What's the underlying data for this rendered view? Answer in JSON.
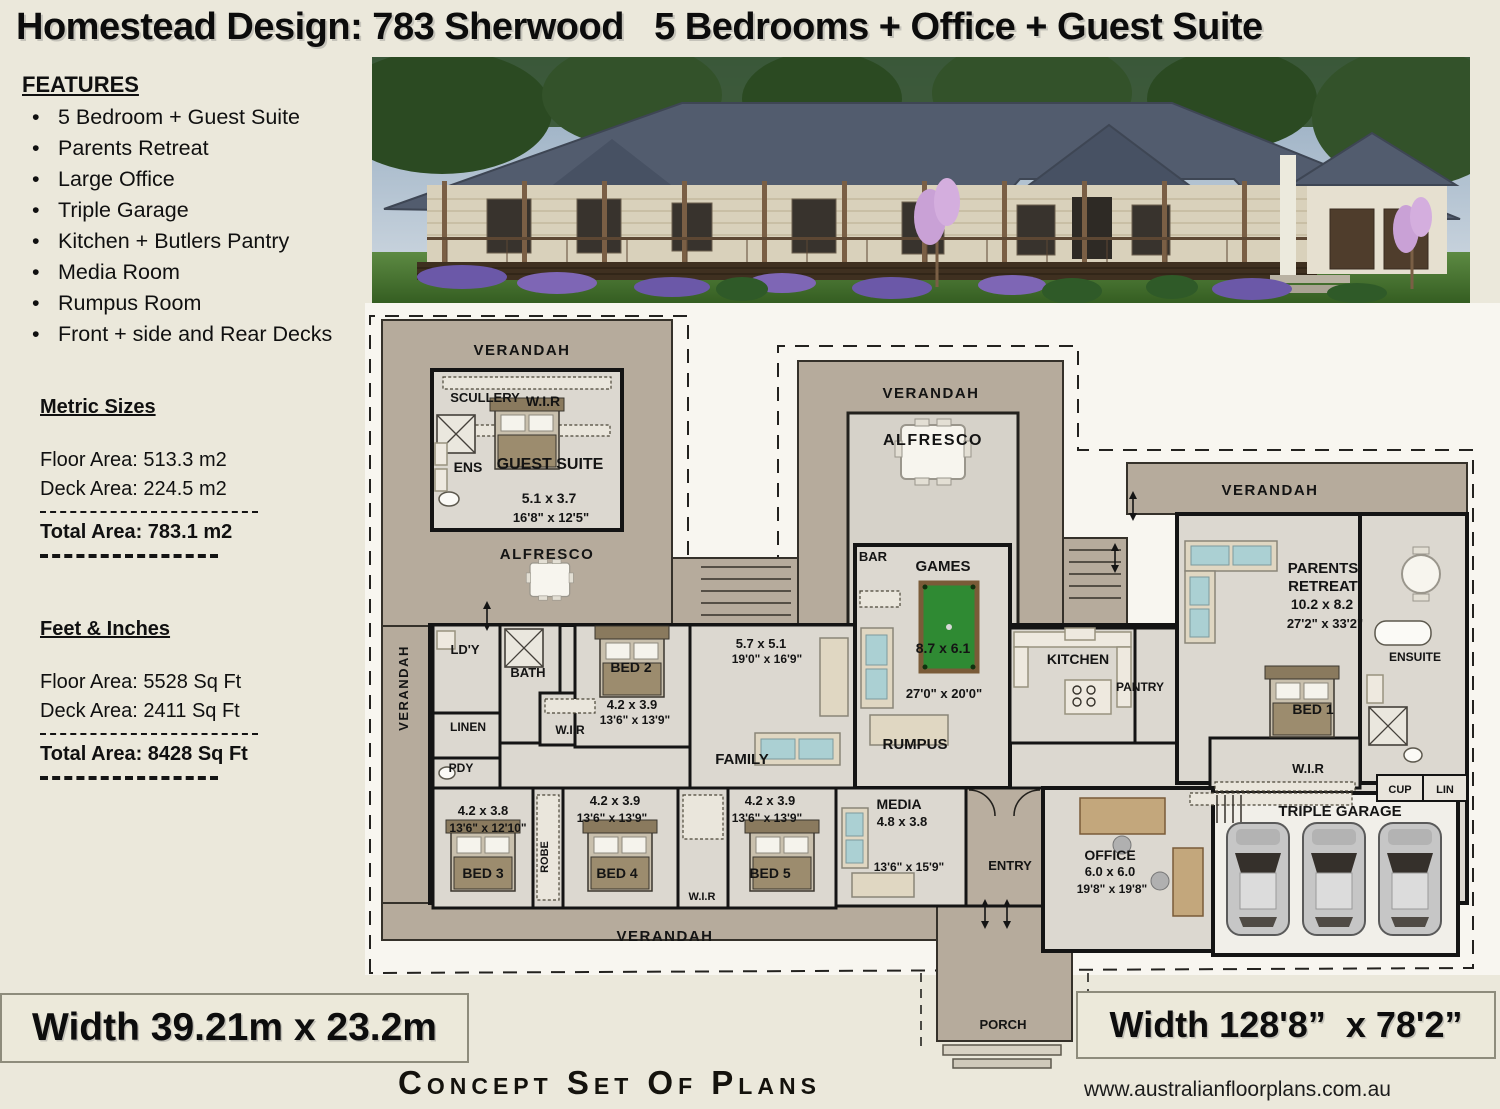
{
  "title": "Homestead Design: 783 Sherwood   5 Bedrooms + Office + Guest Suite",
  "features": {
    "heading": "FEATURES",
    "items": [
      "5 Bedroom + Guest Suite",
      "Parents Retreat",
      "Large Office",
      "Triple Garage",
      "Kitchen + Butlers Pantry",
      "Media Room",
      "Rumpus Room",
      "Front + side and Rear Decks"
    ]
  },
  "metric": {
    "heading": "Metric Sizes",
    "floor": "Floor Area: 513.3 m2",
    "deck": "Deck Area: 224.5 m2",
    "total": "Total Area: 783.1 m2"
  },
  "imperial": {
    "heading": "Feet & Inches",
    "floor": "Floor Area: 5528 Sq Ft",
    "deck": "Deck Area: 2411 Sq Ft",
    "total": "Total Area: 8428 Sq Ft"
  },
  "plan": {
    "verandah": "VERANDAH",
    "alfresco": "ALFRESCO",
    "porch": "PORCH",
    "bar": "BAR",
    "scullery": "SCULLERY",
    "wir": "W.I.R",
    "ens": "ENS",
    "ensuite": "ENSUITE",
    "cup": "CUP",
    "lin": "LIN",
    "ldy": "LD'Y",
    "bath": "BATH",
    "linen": "LINEN",
    "pdy": "PDY",
    "robe": "ROBE",
    "kitchen": "KITCHEN",
    "pantry": "PANTRY",
    "rumpus": "RUMPUS",
    "family": "FAMILY",
    "entry": "ENTRY",
    "media": "MEDIA",
    "office": "OFFICE",
    "garage": "TRIPLE GARAGE",
    "games": "GAMES",
    "guest": "GUEST SUITE",
    "parents_line1": "PARENTS",
    "parents_line2": "RETREAT",
    "bed1": "BED 1",
    "bed2": "BED 2",
    "bed3": "BED 3",
    "bed4": "BED 4",
    "bed5": "BED 5",
    "dims": {
      "guest_m": "5.1 x 3.7",
      "guest_i": "16'8\" x 12'5\"",
      "family_m": "5.7 x 5.1",
      "family_i": "19'0\" x 16'9\"",
      "bed2_m": "4.2 x 3.9",
      "bed2_i": "13'6\" x 13'9\"",
      "games_m": "8.7 x 6.1",
      "games_i": "27'0\" x 20'0\"",
      "parents_m": "10.2 x 8.2",
      "parents_i": "27'2\" x 33'2\"",
      "bed3_m": "4.2 x 3.8",
      "bed3_i": "13'6\" x 12'10\"",
      "bed4_m": "4.2 x 3.9",
      "bed4_i": "13'6\" x 13'9\"",
      "bed5_m": "4.2 x 3.9",
      "bed5_i": "13'6\" x 13'9\"",
      "media_m": "4.8 x 3.8",
      "media_i": "13'6\" x 15'9\"",
      "office_m": "6.0 x 6.0",
      "office_i": "19'8\" x 19'8\""
    }
  },
  "footer": {
    "width_metric": "Width 39.21m x 23.2m",
    "width_imperial": "Width 128'8”  x 78'2”",
    "concept": "Concept Set Of Plans",
    "website": "www.australianfloorplans.com.au"
  },
  "colors": {
    "deck": "#b6ab9c",
    "interior": "#dcd8d0",
    "pool_table": "#2f8a33",
    "page_bg": "#ebe8db"
  }
}
